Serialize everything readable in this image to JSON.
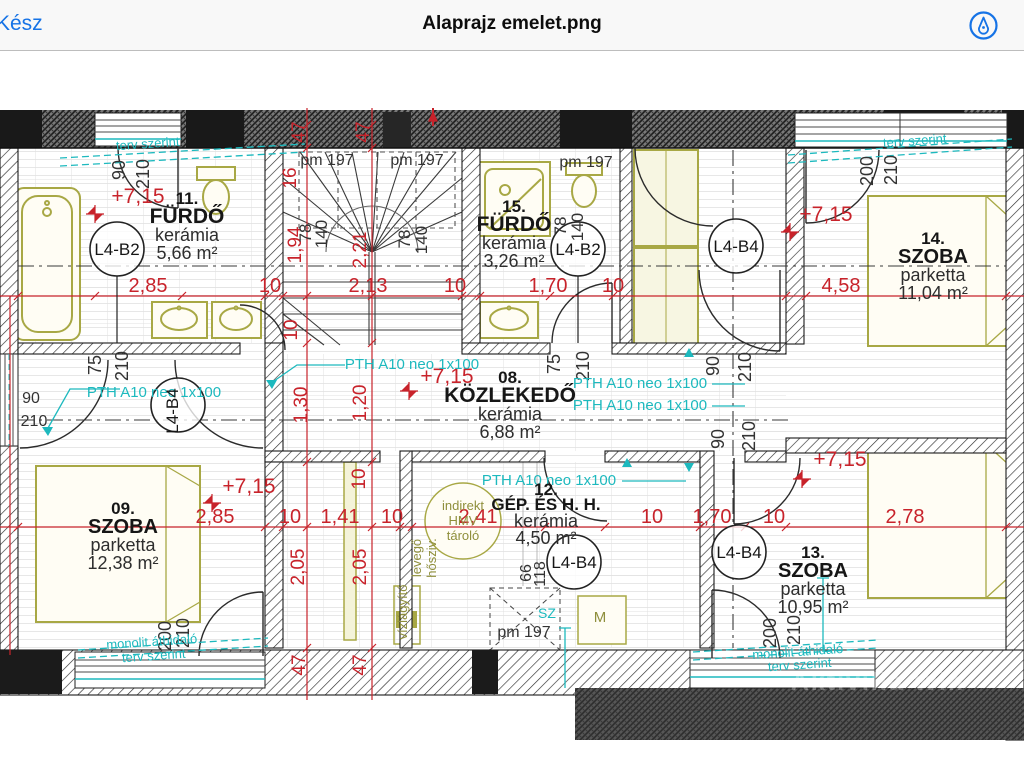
{
  "header": {
    "done_label": "Kész",
    "title": "Alaprajz emelet.png",
    "accent_color": "#1673e6",
    "markup_icon": "markup-pen-icon"
  },
  "plan": {
    "colors": {
      "dimension_red": "#c8232b",
      "annotation_teal": "#1db9be",
      "furniture_olive": "#a8a845",
      "wall_dark": "#1a1a1a"
    },
    "watermark": "Aktivilla Win",
    "rooms": [
      {
        "number": "11.",
        "name": "FÜRDŐ",
        "finish": "kerámia",
        "area": "5,66 m²",
        "cx": 187,
        "y": 204,
        "name_size": 21
      },
      {
        "number": "15.",
        "name": "FÜRDŐ",
        "finish": "kerámia",
        "area": "3,26 m²",
        "cx": 514,
        "y": 212,
        "name_size": 21
      },
      {
        "number": "14.",
        "name": "SZOBA",
        "finish": "parketta",
        "area": "11,04 m²",
        "cx": 933,
        "y": 244,
        "name_size": 20
      },
      {
        "number": "08.",
        "name": "KÖZLEKEDŐ",
        "finish": "kerámia",
        "area": "6,88 m²",
        "cx": 510,
        "y": 383,
        "name_size": 21
      },
      {
        "number": "09.",
        "name": "SZOBA",
        "finish": "parketta",
        "area": "12,38 m²",
        "cx": 123,
        "y": 514,
        "name_size": 20
      },
      {
        "number": "12.",
        "name": "GÉP. ÉS H. H.",
        "finish": "kerámia",
        "area": "4,50 m²",
        "cx": 546,
        "y": 495,
        "name_size": 17,
        "dy": [
          0,
          15,
          32,
          49
        ]
      },
      {
        "number": "13.",
        "name": "SZOBA",
        "finish": "parketta",
        "area": "10,95 m²",
        "cx": 813,
        "y": 558,
        "name_size": 20
      }
    ],
    "tags": [
      {
        "t": "L4-B2",
        "x": 117,
        "y": 249
      },
      {
        "t": "L4-B2",
        "x": 578,
        "y": 249
      },
      {
        "t": "L4-B4",
        "x": 736,
        "y": 246
      },
      {
        "t": "L4-B4",
        "x": 178,
        "y": 405,
        "r": -90
      },
      {
        "t": "L4-B4",
        "x": 574,
        "y": 562
      },
      {
        "t": "L4-B4",
        "x": 739,
        "y": 552
      }
    ],
    "labels": [
      {
        "t": "2,85",
        "x": 148,
        "y": 292,
        "c": "red",
        "s": 20
      },
      {
        "t": "10",
        "x": 270,
        "y": 292,
        "c": "red",
        "s": 20
      },
      {
        "t": "2,13",
        "x": 368,
        "y": 292,
        "c": "red",
        "s": 20
      },
      {
        "t": "10",
        "x": 455,
        "y": 292,
        "c": "red",
        "s": 20
      },
      {
        "t": "1,70",
        "x": 548,
        "y": 292,
        "c": "red",
        "s": 20
      },
      {
        "t": "10",
        "x": 613,
        "y": 292,
        "c": "red",
        "s": 20
      },
      {
        "t": "4,58",
        "x": 841,
        "y": 292,
        "c": "red",
        "s": 20
      },
      {
        "t": "2,85",
        "x": 215,
        "y": 523,
        "c": "red",
        "s": 20
      },
      {
        "t": "10",
        "x": 290,
        "y": 523,
        "c": "red",
        "s": 20
      },
      {
        "t": "1,41",
        "x": 340,
        "y": 523,
        "c": "red",
        "s": 20
      },
      {
        "t": "10",
        "x": 392,
        "y": 523,
        "c": "red",
        "s": 20
      },
      {
        "t": "2,41",
        "x": 478,
        "y": 523,
        "c": "red",
        "s": 20
      },
      {
        "t": "10",
        "x": 652,
        "y": 523,
        "c": "red",
        "s": 20
      },
      {
        "t": "1,70",
        "x": 712,
        "y": 523,
        "c": "red",
        "s": 20
      },
      {
        "t": "10",
        "x": 774,
        "y": 523,
        "c": "red",
        "s": 20
      },
      {
        "t": "2,78",
        "x": 905,
        "y": 523,
        "c": "red",
        "s": 20
      },
      {
        "t": "47",
        "x": 305,
        "y": 132,
        "c": "red",
        "s": 19,
        "r": -90
      },
      {
        "t": "47",
        "x": 369,
        "y": 132,
        "c": "red",
        "s": 19,
        "r": -90
      },
      {
        "t": "16",
        "x": 296,
        "y": 178,
        "c": "red",
        "s": 19,
        "r": -90
      },
      {
        "t": "1,94",
        "x": 301,
        "y": 245,
        "c": "red",
        "s": 19,
        "r": -90
      },
      {
        "t": "2,21",
        "x": 366,
        "y": 250,
        "c": "red",
        "s": 19,
        "r": -90
      },
      {
        "t": "10",
        "x": 297,
        "y": 330,
        "c": "red",
        "s": 19,
        "r": -90
      },
      {
        "t": "1,30",
        "x": 307,
        "y": 405,
        "c": "red",
        "s": 19,
        "r": -90
      },
      {
        "t": "1,20",
        "x": 366,
        "y": 403,
        "c": "red",
        "s": 19,
        "r": -90
      },
      {
        "t": "10",
        "x": 365,
        "y": 479,
        "c": "red",
        "s": 19,
        "r": -90
      },
      {
        "t": "2,05",
        "x": 304,
        "y": 567,
        "c": "red",
        "s": 19,
        "r": -90
      },
      {
        "t": "2,05",
        "x": 366,
        "y": 567,
        "c": "red",
        "s": 19,
        "r": -90
      },
      {
        "t": "47",
        "x": 305,
        "y": 665,
        "c": "red",
        "s": 19,
        "r": -90
      },
      {
        "t": "47",
        "x": 366,
        "y": 665,
        "c": "red",
        "s": 19,
        "r": -90
      },
      {
        "t": "+7,15",
        "x": 138,
        "y": 203,
        "c": "red",
        "s": 21
      },
      {
        "t": "+7,15",
        "x": 826,
        "y": 221,
        "c": "red",
        "s": 21
      },
      {
        "t": "+7,15",
        "x": 447,
        "y": 383,
        "c": "red",
        "s": 21
      },
      {
        "t": "+7,15",
        "x": 249,
        "y": 493,
        "c": "red",
        "s": 21
      },
      {
        "t": "+7,15",
        "x": 840,
        "y": 466,
        "c": "red",
        "s": 21
      },
      {
        "t": "90",
        "x": 125,
        "y": 170,
        "c": "dim",
        "s": 18,
        "r": -90
      },
      {
        "t": "210",
        "x": 149,
        "y": 174,
        "c": "dim",
        "s": 18,
        "r": -90
      },
      {
        "t": "78",
        "x": 311,
        "y": 233,
        "c": "dim",
        "s": 17,
        "r": -90
      },
      {
        "t": "140",
        "x": 327,
        "y": 234,
        "c": "dim",
        "s": 17,
        "r": -90
      },
      {
        "t": "78",
        "x": 410,
        "y": 239,
        "c": "dim",
        "s": 17,
        "r": -90
      },
      {
        "t": "140",
        "x": 427,
        "y": 240,
        "c": "dim",
        "s": 17,
        "r": -90
      },
      {
        "t": "78",
        "x": 566,
        "y": 226,
        "c": "dim",
        "s": 17,
        "r": -90
      },
      {
        "t": "140",
        "x": 583,
        "y": 227,
        "c": "dim",
        "s": 17,
        "r": -90
      },
      {
        "t": "200",
        "x": 873,
        "y": 171,
        "c": "dim",
        "s": 18,
        "r": -90
      },
      {
        "t": "210",
        "x": 897,
        "y": 170,
        "c": "dim",
        "s": 18,
        "r": -90
      },
      {
        "t": "90",
        "x": 719,
        "y": 366,
        "c": "dim",
        "s": 18,
        "r": -90
      },
      {
        "t": "210",
        "x": 751,
        "y": 367,
        "c": "dim",
        "s": 18,
        "r": -90
      },
      {
        "t": "90",
        "x": 724,
        "y": 439,
        "c": "dim",
        "s": 18,
        "r": -90
      },
      {
        "t": "210",
        "x": 755,
        "y": 436,
        "c": "dim",
        "s": 18,
        "r": -90
      },
      {
        "t": "75",
        "x": 560,
        "y": 364,
        "c": "dim",
        "s": 18,
        "r": -90
      },
      {
        "t": "210",
        "x": 589,
        "y": 366,
        "c": "dim",
        "s": 18,
        "r": -90
      },
      {
        "t": "75",
        "x": 101,
        "y": 365,
        "c": "dim",
        "s": 18,
        "r": -90
      },
      {
        "t": "210",
        "x": 128,
        "y": 366,
        "c": "dim",
        "s": 18,
        "r": -90
      },
      {
        "t": "66",
        "x": 531,
        "y": 573,
        "c": "dim",
        "s": 16,
        "r": -90
      },
      {
        "t": "118",
        "x": 545,
        "y": 574,
        "c": "dim",
        "s": 16,
        "r": -90
      },
      {
        "t": "200",
        "x": 171,
        "y": 636,
        "c": "dim",
        "s": 18,
        "r": -90
      },
      {
        "t": "210",
        "x": 189,
        "y": 633,
        "c": "dim",
        "s": 18,
        "r": -90
      },
      {
        "t": "200",
        "x": 776,
        "y": 633,
        "c": "dim",
        "s": 18,
        "r": -90
      },
      {
        "t": "210",
        "x": 800,
        "y": 630,
        "c": "dim",
        "s": 18,
        "r": -90
      },
      {
        "t": "90",
        "x": 31,
        "y": 403,
        "c": "dim",
        "s": 16
      },
      {
        "t": "210",
        "x": 34,
        "y": 426,
        "c": "dim",
        "s": 16
      },
      {
        "t": "pm 197",
        "x": 327,
        "y": 165,
        "c": "dim",
        "s": 16
      },
      {
        "t": "pm 197",
        "x": 417,
        "y": 165,
        "c": "dim",
        "s": 16
      },
      {
        "t": "pm 197",
        "x": 586,
        "y": 167,
        "c": "dim",
        "s": 16
      },
      {
        "t": "pm 197",
        "x": 524,
        "y": 637,
        "c": "dim",
        "s": 16
      },
      {
        "t": "PTH A10 neo 1x100",
        "x": 412,
        "y": 369,
        "c": "teal",
        "s": 15
      },
      {
        "t": "PTH A10 neo 1x100",
        "x": 154,
        "y": 397,
        "c": "teal",
        "s": 15
      },
      {
        "t": "PTH A10 neo 1x100",
        "x": 640,
        "y": 388,
        "c": "teal",
        "s": 15
      },
      {
        "t": "PTH A10 neo 1x100",
        "x": 640,
        "y": 410,
        "c": "teal",
        "s": 15
      },
      {
        "t": "PTH A10 neo 1x100",
        "x": 549,
        "y": 485,
        "c": "teal",
        "s": 15
      },
      {
        "t": "terv szerint",
        "x": 148,
        "y": 148,
        "c": "teal",
        "s": 13,
        "r": -4
      },
      {
        "t": "terv szerint",
        "x": 915,
        "y": 145,
        "c": "teal",
        "s": 13,
        "r": -4
      },
      {
        "t": "monolit áthidaló",
        "x": 152,
        "y": 646,
        "c": "teal",
        "s": 13,
        "r": -4
      },
      {
        "t": "terv szerint",
        "x": 154,
        "y": 660,
        "c": "teal",
        "s": 13,
        "r": -4
      },
      {
        "t": "monolit áthidaló",
        "x": 798,
        "y": 656,
        "c": "teal",
        "s": 13,
        "r": -4
      },
      {
        "t": "terv szerint",
        "x": 800,
        "y": 669,
        "c": "teal",
        "s": 13,
        "r": -4
      },
      {
        "t": "SZ",
        "x": 547,
        "y": 618,
        "c": "teal",
        "s": 14
      },
      {
        "t": "indirekt",
        "x": 463,
        "y": 510,
        "c": "olive",
        "s": 13
      },
      {
        "t": "HMV",
        "x": 463,
        "y": 525,
        "c": "olive",
        "s": 13
      },
      {
        "t": "tároló",
        "x": 463,
        "y": 540,
        "c": "olive",
        "s": 13
      },
      {
        "t": "levegő",
        "x": 421,
        "y": 558,
        "c": "olive",
        "s": 13,
        "r": -90
      },
      {
        "t": "hősziv.",
        "x": 436,
        "y": 558,
        "c": "olive",
        "s": 13,
        "r": -90
      },
      {
        "t": "vízlágyító",
        "x": 407,
        "y": 612,
        "c": "olive",
        "s": 13,
        "r": -90
      },
      {
        "t": "M",
        "x": 600,
        "y": 622,
        "c": "olive",
        "s": 15
      },
      {
        "t": "Aktivilla Win",
        "x": 878,
        "y": 690,
        "c": "wm",
        "s": 25
      }
    ]
  }
}
